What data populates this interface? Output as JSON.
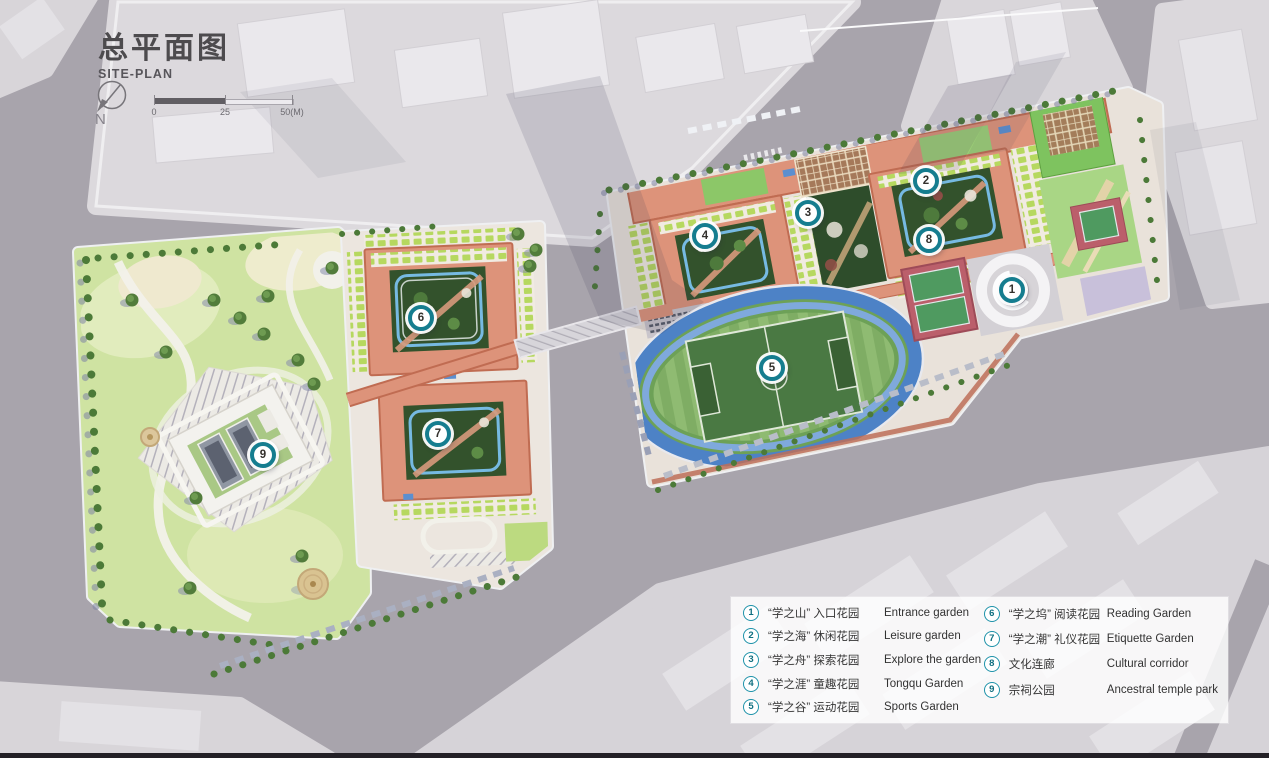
{
  "header": {
    "title_cn": "总平面图",
    "title_en": "SITE-PLAN",
    "north_label": "N"
  },
  "scale_bar": {
    "ticks": [
      "0",
      "25",
      "50(M)"
    ]
  },
  "legend": {
    "items": [
      {
        "id": "1",
        "cn": "“学之山” 入口花园",
        "en": "Entrance garden"
      },
      {
        "id": "2",
        "cn": "“学之海” 休闲花园",
        "en": "Leisure garden"
      },
      {
        "id": "3",
        "cn": "“学之舟” 探索花园",
        "en": "Explore the garden"
      },
      {
        "id": "4",
        "cn": "“学之涯” 童趣花园",
        "en": "Tongqu Garden"
      },
      {
        "id": "5",
        "cn": "“学之谷” 运动花园",
        "en": "Sports Garden"
      },
      {
        "id": "6",
        "cn": "“学之坞” 阅读花园",
        "en": "Reading Garden"
      },
      {
        "id": "7",
        "cn": "“学之潮” 礼仪花园",
        "en": "Etiquette Garden"
      },
      {
        "id": "8",
        "cn": "文化连廊",
        "en": "Cultural corridor"
      },
      {
        "id": "9",
        "cn": "宗祠公园",
        "en": "Ancestral temple park"
      }
    ]
  },
  "markers": [
    {
      "id": "1",
      "x": 1012,
      "y": 290
    },
    {
      "id": "2",
      "x": 926,
      "y": 181
    },
    {
      "id": "3",
      "x": 808,
      "y": 213
    },
    {
      "id": "4",
      "x": 705,
      "y": 236
    },
    {
      "id": "5",
      "x": 772,
      "y": 368
    },
    {
      "id": "6",
      "x": 421,
      "y": 318
    },
    {
      "id": "7",
      "x": 438,
      "y": 434
    },
    {
      "id": "8",
      "x": 929,
      "y": 240
    },
    {
      "id": "9",
      "x": 263,
      "y": 455
    }
  ],
  "colors": {
    "marker_teal": "#157d8f",
    "legend_badge_ring": "#1f93aa",
    "building_salmon": "#dd937a",
    "roof_tile_green": "#b6d85f",
    "courtyard_green": "#33522c",
    "track_blue": "#4d82c6",
    "field_green": "#6da157",
    "court_red": "#bb5f6b",
    "park_green": "#cfe3a2",
    "road_gray": "#a8a4ac",
    "title_gray": "#4d4b4e"
  }
}
